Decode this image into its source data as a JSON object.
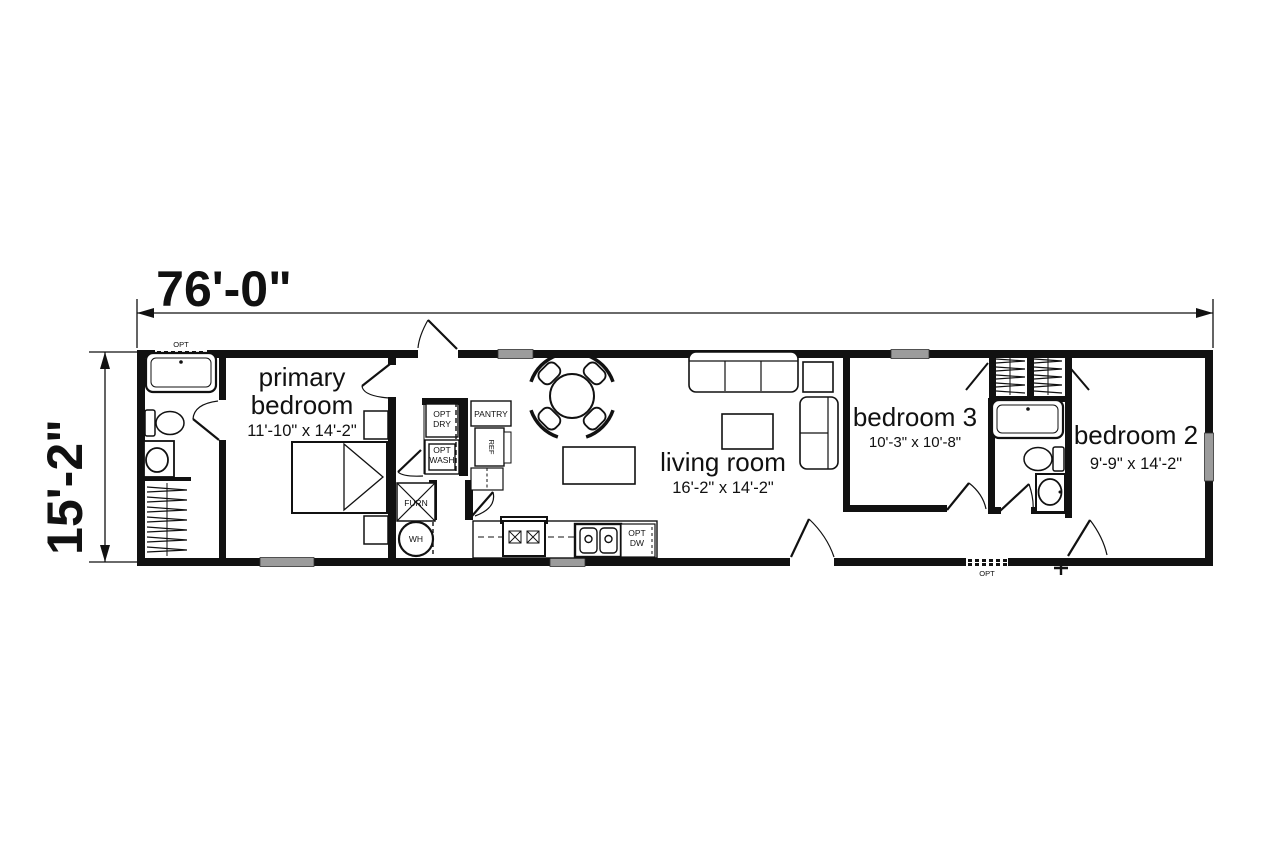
{
  "floor_plan": {
    "overall_width": "76'-0\"",
    "overall_depth": "15'-2\"",
    "rooms": {
      "primary_bedroom": {
        "name_line1": "primary",
        "name_line2": "bedroom",
        "size": "11'-10\" x 14'-2\""
      },
      "living_room": {
        "name": "living room",
        "size": "16'-2\" x 14'-2\""
      },
      "bedroom_3": {
        "name": "bedroom 3",
        "size": "10'-3\" x 10'-8\""
      },
      "bedroom_2": {
        "name": "bedroom 2",
        "size": "9'-9\" x 14'-2\""
      }
    },
    "labels": {
      "opt": "OPT",
      "dry": "DRY",
      "wash": "WASH",
      "pantry": "PANTRY",
      "refrigerator": "REF",
      "furnace": "FURN",
      "water_heater": "WH",
      "dishwasher": "DW"
    }
  }
}
